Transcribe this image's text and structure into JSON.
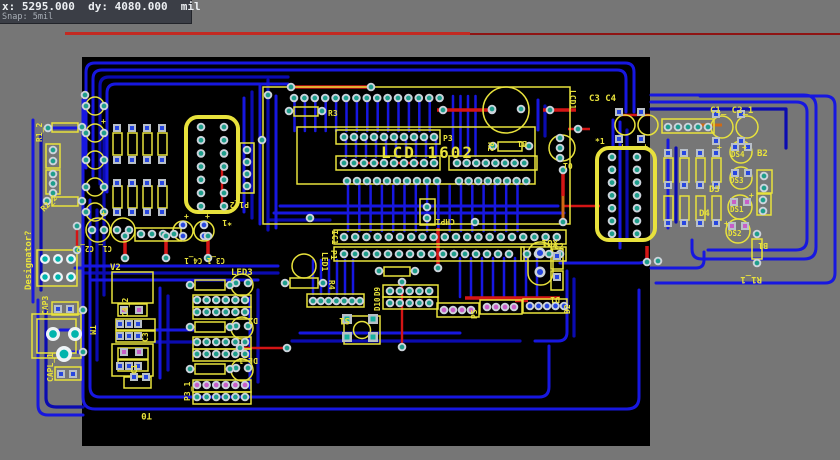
{
  "status_box": {
    "line1": "x: 5295.000  dy: 4080.000  mil",
    "line2": "Snap: 5mil"
  },
  "board": {
    "labels": {
      "lcd_title": "LCD 1602",
      "lcd1": "LCD1",
      "p3": "P3",
      "r3": "R3",
      "r2": "R2",
      "b1": "B1",
      "t0": "T0",
      "y_star": "*1",
      "ic1": "IC1",
      "p1": "P1",
      "chp1": "CHP1",
      "led1": "LED1",
      "r4": "R4",
      "s1": "S1",
      "d9": "D9",
      "d10": "D10",
      "p5": "P5",
      "d1": "D1",
      "d2": "D2",
      "xu1": "XU1",
      "c2": "C2",
      "c3c4": "C3 C4",
      "c1c2_1": "C1_ C2_1",
      "b2": "B2",
      "ds4": "DS4",
      "ds3": "DS3",
      "ds1": "DS1",
      "ds2": "DS2",
      "d3": "D3",
      "d4": "D4",
      "r1_1": "R1_1",
      "r1_2": "R1_2",
      "r2_2": "R2_2",
      "p1_2": "P1_2",
      "designator": "Designator?",
      "cap3": "CAP3",
      "capl_1": "CAPL_1",
      "tm": "TM",
      "v2": "V2",
      "c4_2": "C4_2",
      "c3": "C3",
      "c1": "C1",
      "t0_b": "T0",
      "led3": "LED3",
      "d2_b": "D2",
      "dl_1": "DL_1",
      "p3_1": "P3_1",
      "c1c2_2": "C1_ C2_2",
      "c3_1c4_1": "C3_1 C4_1",
      "plus": "+"
    }
  }
}
